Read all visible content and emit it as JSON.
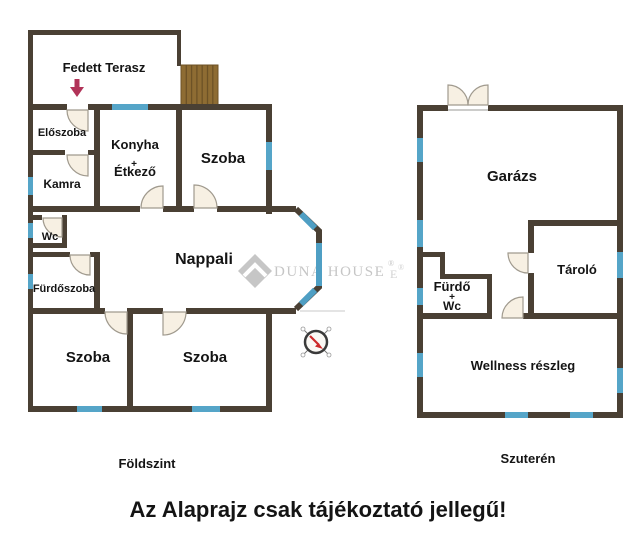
{
  "ground_floor": {
    "caption": "Földszint",
    "rooms": {
      "terrace": "Fedett Terasz",
      "entry": "Előszoba",
      "kitchen": "Konyha",
      "kitchen_plus": "+",
      "dining": "Étkező",
      "room_top": "Szoba",
      "pantry": "Kamra",
      "wc": "Wc",
      "living_room": "Nappali",
      "bathroom": "Fürdőszoba",
      "room_bottom_left": "Szoba",
      "room_bottom_middle": "Szoba"
    }
  },
  "basement": {
    "caption": "Szuterén",
    "rooms": {
      "garage": "Garázs",
      "storage": "Tároló",
      "bath": "Fürdő",
      "bath_plus": "+",
      "bath_wc": "Wc",
      "wellness": "Wellness részleg"
    }
  },
  "watermark": {
    "brand": "DUNA HOUSE",
    "registered": "®",
    "stray_fragment": "E",
    "stray_registered": "®"
  },
  "disclaimer": "Az Alaprajz csak tájékoztató jellegű!",
  "colors": {
    "wall": "#4a4034",
    "window": "#55a5c8",
    "stairs_fill": "#8e6c33",
    "stairs_lines": "#6d5226",
    "door_fill": "#f7f0e3",
    "terrace_arrow": "#b13358",
    "compass_needle": "#cc2a2a",
    "watermark_gray": "#c6c6c6"
  }
}
